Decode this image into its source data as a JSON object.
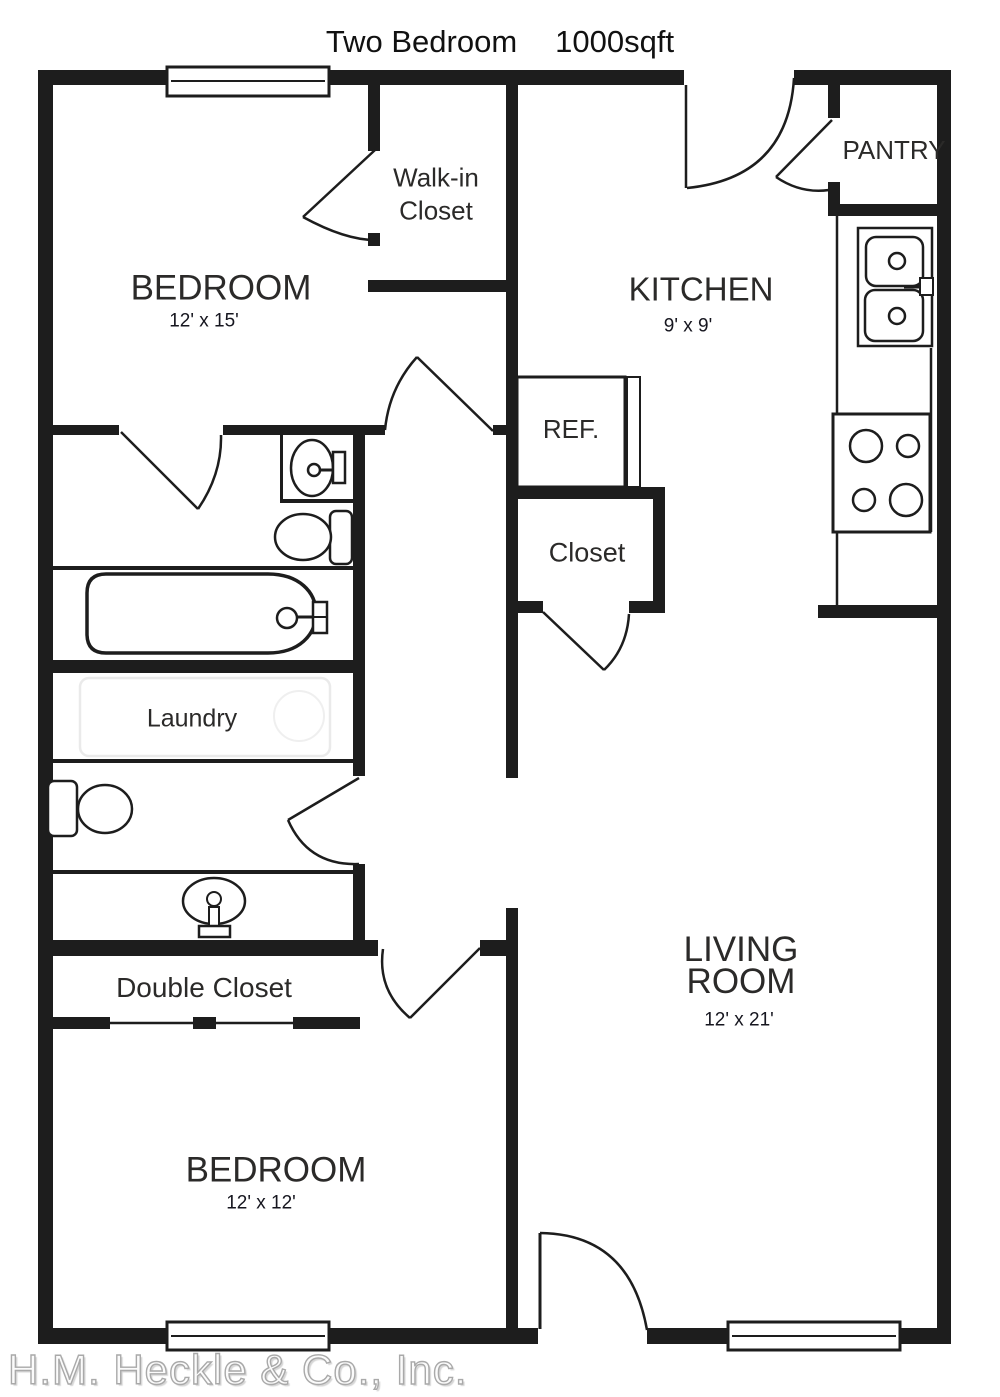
{
  "title": {
    "plan_type": "Two Bedroom",
    "area": "1000sqft"
  },
  "watermark": "H.M. Heckle & Co., Inc.",
  "rooms": {
    "bedroom_top": {
      "label": "BEDROOM",
      "dims": "12' x 15'"
    },
    "walk_in_closet": {
      "line1": "Walk-in",
      "line2": "Closet"
    },
    "kitchen": {
      "label": "KITCHEN",
      "dims": "9' x 9'"
    },
    "pantry": {
      "label": "PANTRY"
    },
    "refrigerator": {
      "label": "REF."
    },
    "hall_closet": {
      "label": "Closet"
    },
    "laundry": {
      "label": "Laundry"
    },
    "double_closet": {
      "label": "Double Closet"
    },
    "bedroom_bottom": {
      "label": "BEDROOM",
      "dims": "12' x 12'"
    },
    "living_room": {
      "line1": "LIVING",
      "line2": "ROOM",
      "dims": "12' x 21'"
    }
  },
  "fixtures": [
    "window",
    "door-swing",
    "bathtub",
    "toilet",
    "vanity-sink",
    "pedestal-sink",
    "double-kitchen-sink",
    "stove-4-burner",
    "refrigerator",
    "double-closet-slider",
    "washer-dryer-ghost"
  ],
  "colors": {
    "wall": "#1d1d1d",
    "fixture_stroke": "#1d1d1d",
    "label_text": "#2b2a29",
    "dims_text": "#16161f",
    "watermark": "#a9a9a9",
    "ghost": "#e9e9e9",
    "background": "#ffffff"
  }
}
